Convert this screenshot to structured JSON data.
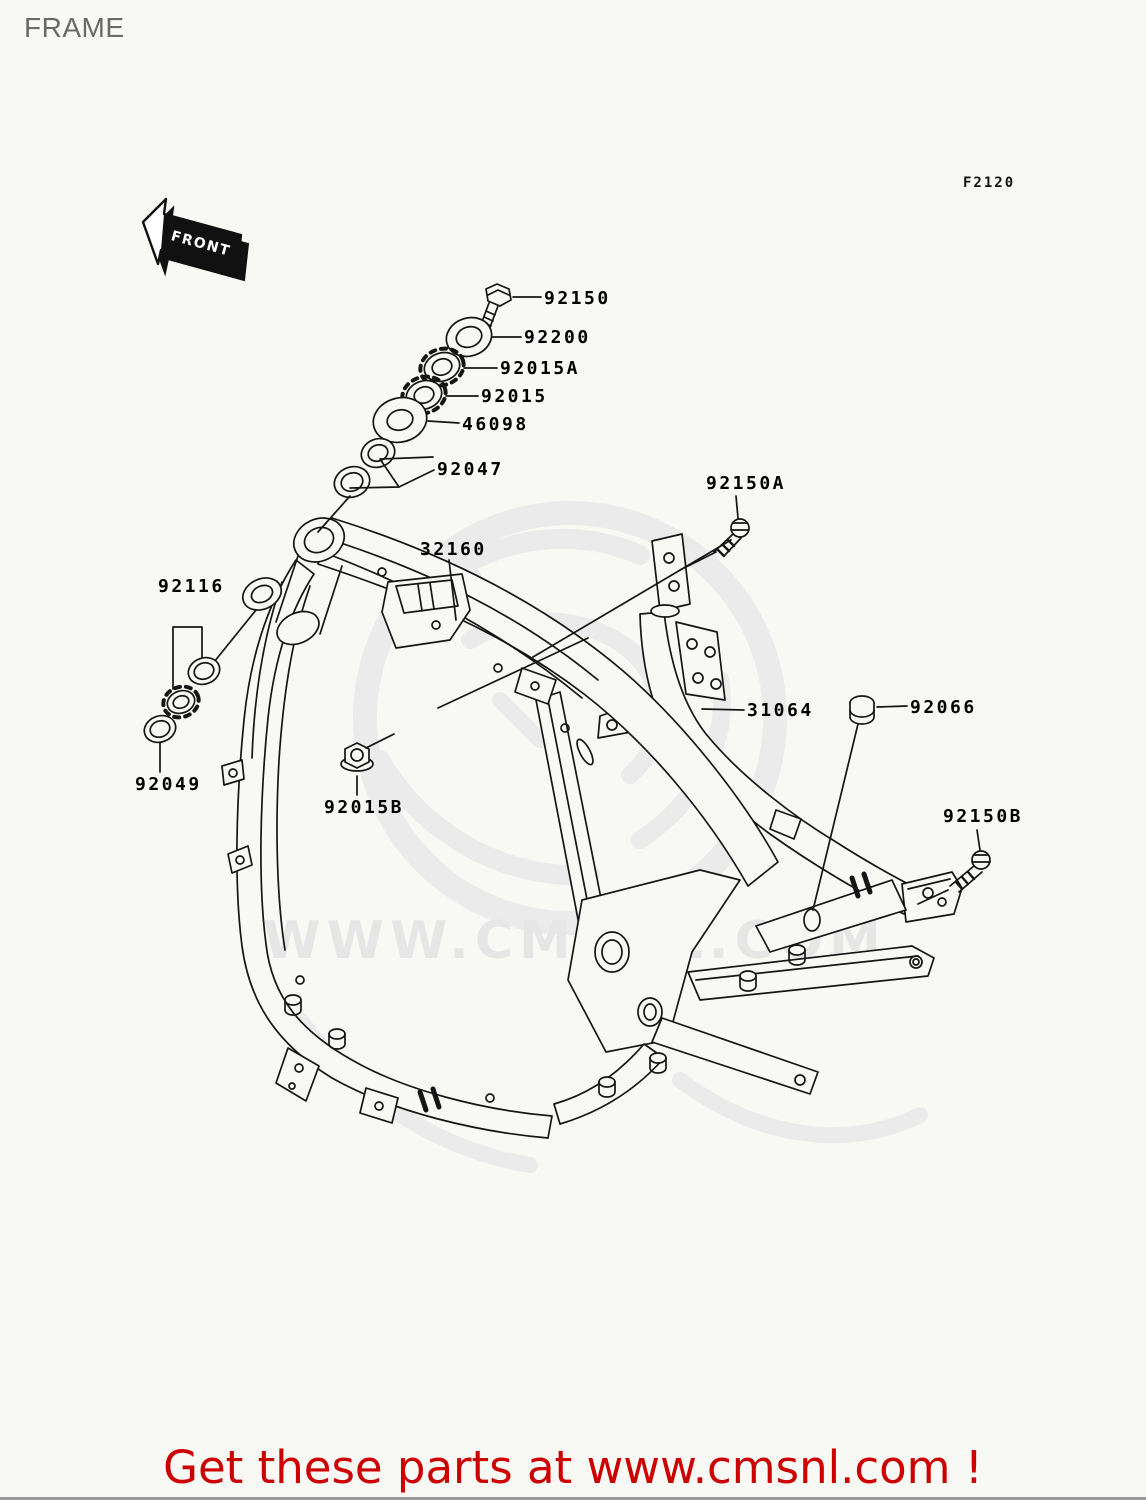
{
  "page": {
    "title": "FRAME",
    "diagram_code": "F2120"
  },
  "front_arrow": {
    "label": "FRONT"
  },
  "watermark": {
    "text": "WWW.CMSNL.COM",
    "color": "#e7e7e7"
  },
  "footer": {
    "text": "Get these parts at www.cmsnl.com !",
    "color": "#cc0000"
  },
  "colors": {
    "background": "#f8f8f4",
    "line": "#151515",
    "label": "#000000",
    "title": "#6a6a6a"
  },
  "parts": [
    {
      "number": "92150",
      "depicts": "hex-bolt"
    },
    {
      "number": "92200",
      "depicts": "washer"
    },
    {
      "number": "92015A",
      "depicts": "castle-nut"
    },
    {
      "number": "92015",
      "depicts": "castle-nut"
    },
    {
      "number": "46098",
      "depicts": "washer"
    },
    {
      "number": "92047",
      "depicts": "bearing-races"
    },
    {
      "number": "92150A",
      "depicts": "bolt"
    },
    {
      "number": "32160",
      "depicts": "main-frame"
    },
    {
      "number": "92116",
      "depicts": "steering-bearing"
    },
    {
      "number": "31064",
      "depicts": "rear-frame-rail"
    },
    {
      "number": "92066",
      "depicts": "plug-cap"
    },
    {
      "number": "92049",
      "depicts": "seal"
    },
    {
      "number": "92015B",
      "depicts": "flange-nut"
    },
    {
      "number": "92150B",
      "depicts": "bolt"
    }
  ]
}
